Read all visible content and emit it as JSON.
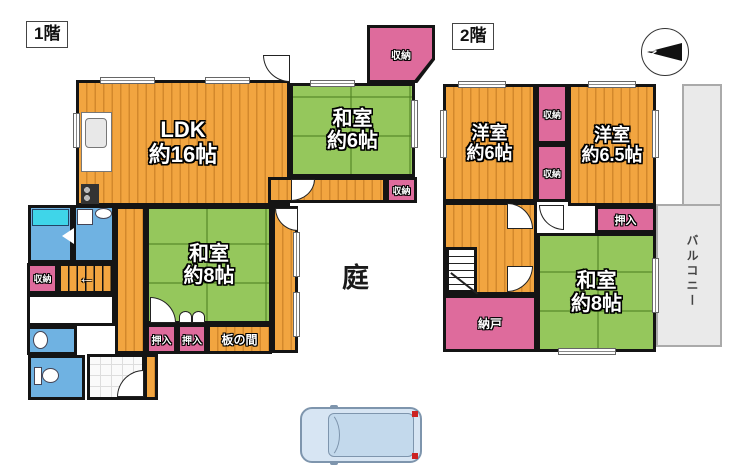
{
  "floor1": {
    "label": "1階",
    "rooms": {
      "ldk": {
        "name": "LDK",
        "size": "約16帖"
      },
      "washitsu6": {
        "name": "和室",
        "size": "約6帖"
      },
      "washitsu8": {
        "name": "和室",
        "size": "約8帖"
      },
      "shuno_top": {
        "name": "収納"
      },
      "shuno_hall": {
        "name": "収納"
      },
      "shuno_left": {
        "name": "収納"
      },
      "oshiire_a": {
        "name": "押入"
      },
      "oshiire_b": {
        "name": "押入"
      },
      "itanoma": {
        "name": "板の間"
      }
    },
    "garden": "庭"
  },
  "floor2": {
    "label": "2階",
    "compass_n": "N",
    "rooms": {
      "yoshitsu6": {
        "name": "洋室",
        "size": "約6帖"
      },
      "yoshitsu65": {
        "name": "洋室",
        "size": "約6.5帖"
      },
      "washitsu8": {
        "name": "和室",
        "size": "約8帖"
      },
      "shuno_a": {
        "name": "収納"
      },
      "shuno_b": {
        "name": "収納"
      },
      "oshiire": {
        "name": "押入"
      },
      "nando": {
        "name": "納戸"
      },
      "balcony": {
        "name": "バルコニー"
      }
    }
  },
  "colors": {
    "wood": "#F2A540",
    "tatami": "#95C75C",
    "closet": "#DE6B9C",
    "wet": "#6FB2E2",
    "tub": "#3FD5E9",
    "wall": "#141414",
    "balcony": "#EAEAEA",
    "car-body": "#D7E5F3",
    "car-line": "#7E95AD",
    "accent-red": "#CC2222"
  }
}
